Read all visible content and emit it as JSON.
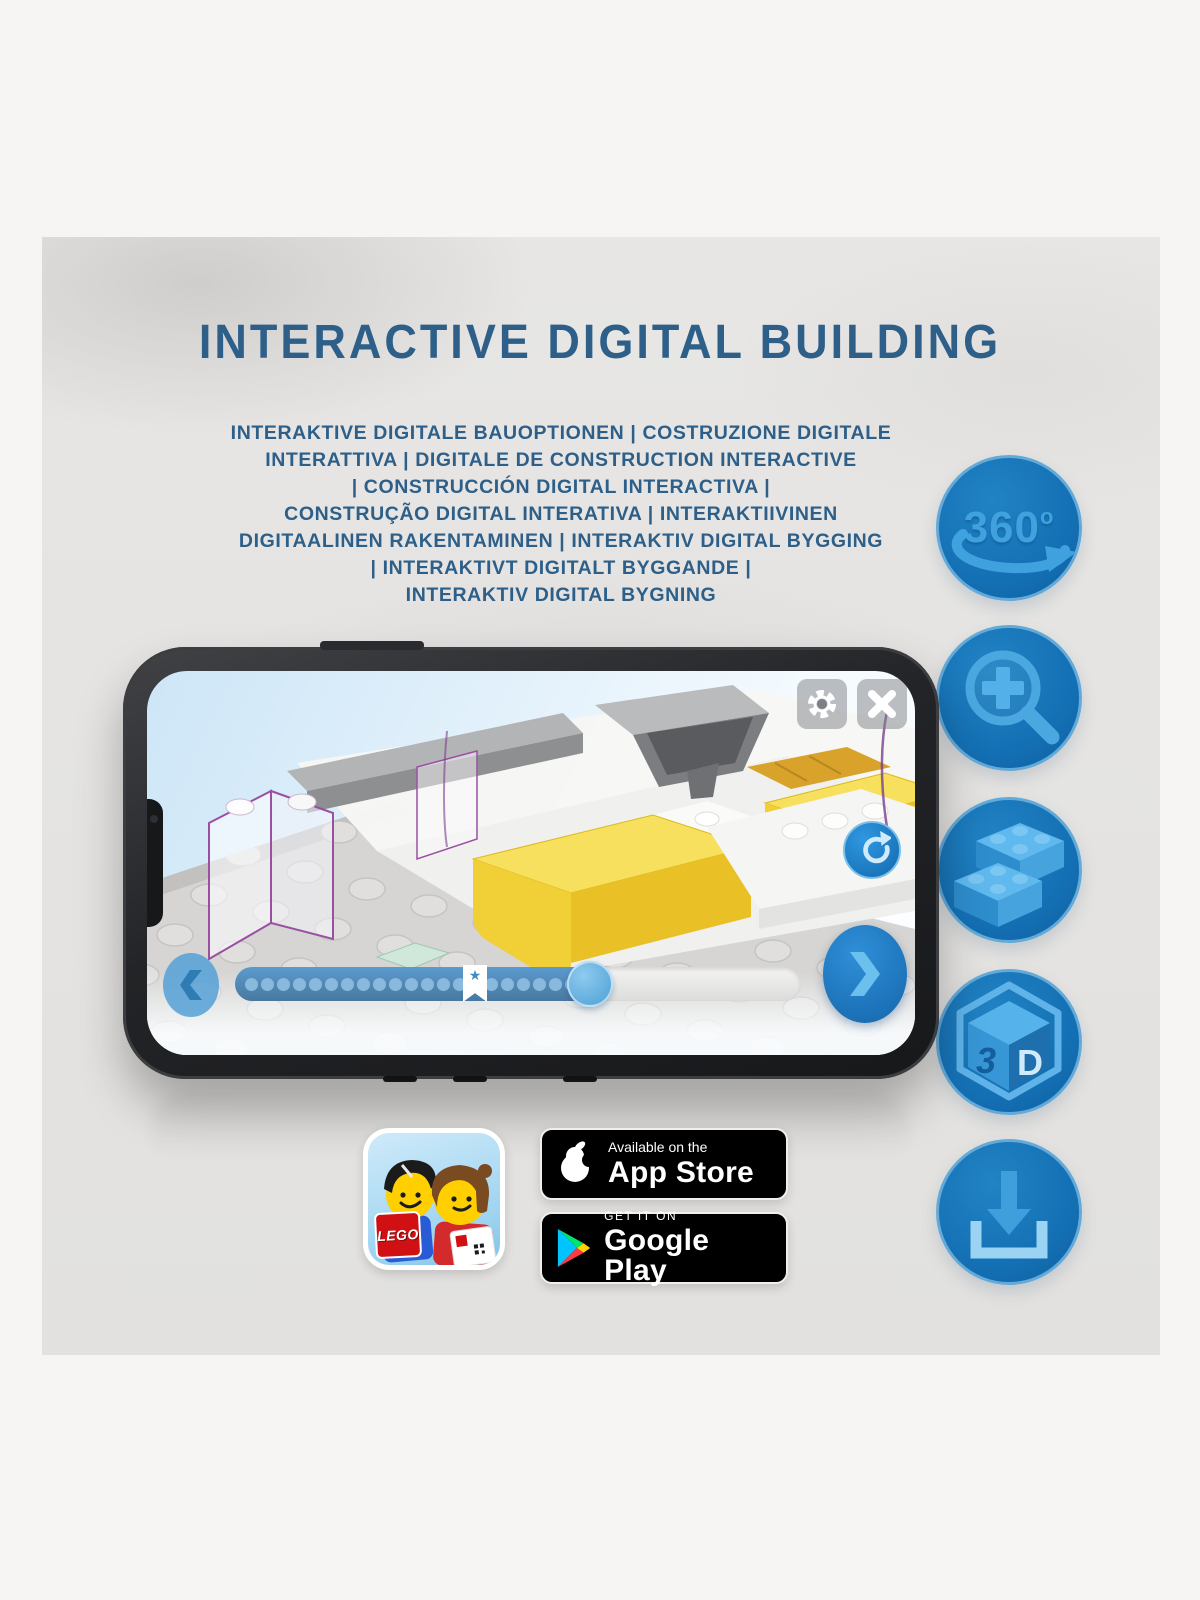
{
  "heading": {
    "title": "INTERACTIVE DIGITAL BUILDING"
  },
  "subtitle": {
    "lines": [
      "INTERAKTIVE DIGITALE BAUOPTIONEN | COSTRUZIONE DIGITALE",
      "INTERATTIVA | DIGITALE DE CONSTRUCTION INTERACTIVE",
      "| CONSTRUCCIÓN DIGITAL INTERACTIVA |",
      "CONSTRUÇÃO DIGITAL INTERATIVA | INTERAKTIIVINEN",
      "DIGITAALINEN RAKENTAMINEN | INTERAKTIV DIGITAL BYGGING",
      "| INTERAKTIVT DIGITALT BYGGANDE |",
      "INTERAKTIV DIGITAL BYGNING"
    ]
  },
  "feature_icons": {
    "rotate360": {
      "value": "360",
      "sup": "o"
    },
    "cube3d": {
      "left": "3",
      "right": "D"
    }
  },
  "phone": {
    "progress": {
      "dot_count": 21,
      "fill_percent": 63
    },
    "icons": {
      "bookmark_star": "★"
    }
  },
  "badges": {
    "app_store": {
      "line1": "Available on the",
      "line2": "App Store"
    },
    "google_play": {
      "line1": "GET IT ON",
      "line2": "Google Play"
    }
  },
  "app_icon": {
    "logo_text": "LEGO"
  },
  "colors": {
    "heading_blue": "#2d5f89",
    "accent_blue": "#1470b4",
    "icon_glyph_blue": "#4aa7e0",
    "brick_yellow": "#f1cf36",
    "badge_black": "#000000"
  }
}
